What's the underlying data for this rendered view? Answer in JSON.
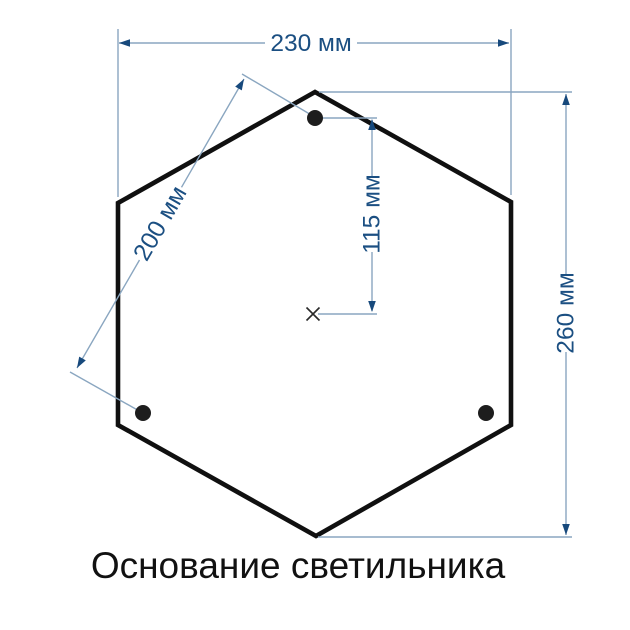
{
  "title": "Основание светильника",
  "drawing": {
    "shape": "hexagonal-plate",
    "mounting_holes": 3,
    "dimensions": {
      "width": {
        "value": 230,
        "unit": "мм",
        "label": "230 мм"
      },
      "hole_spacing": {
        "value": 200,
        "unit": "мм",
        "label": "200 мм"
      },
      "hole_offset": {
        "value": 115,
        "unit": "мм",
        "label": "115 мм"
      },
      "height": {
        "value": 260,
        "unit": "мм",
        "label": "260 мм"
      }
    }
  },
  "colors": {
    "background": "#ffffff",
    "outline": "#101010",
    "dimension_line": "#8aa6c0",
    "dimension_accent": "#17497c",
    "dimension_text": "#1b4f82",
    "title_text": "#111111"
  }
}
